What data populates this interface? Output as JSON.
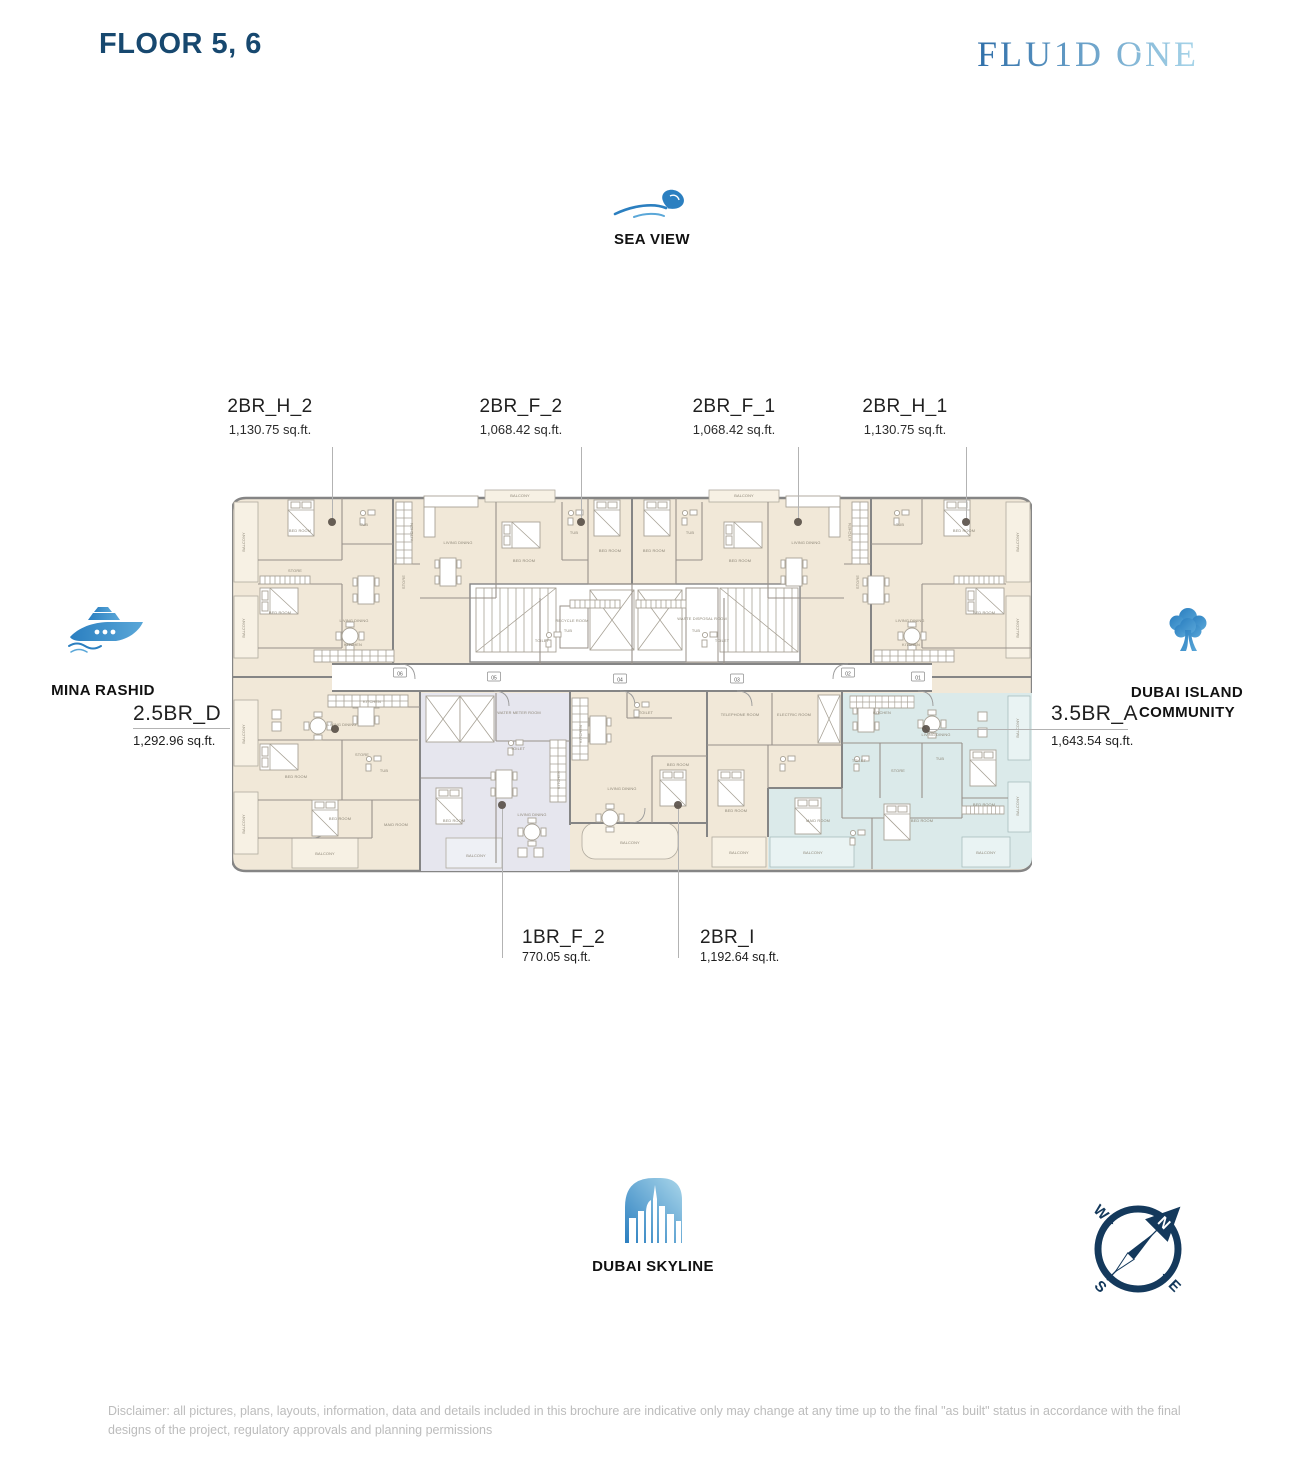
{
  "page": {
    "title": "FLOOR 5, 6",
    "brand": "FLU1D ONE",
    "disclaimer": "Disclaimer: all pictures, plans, layouts, information, data and details included in this brochure are indicative only may change at any time up to the final \"as built\" status in accordance with the final designs of the project, regulatory approvals and planning permissions"
  },
  "landmarks": {
    "top": {
      "label": "SEA VIEW",
      "icon": "wave-icon"
    },
    "left": {
      "label": "MINA RASHID",
      "icon": "ship-icon"
    },
    "right": {
      "label": "DUBAI ISLAND COMMUNITY",
      "icon": "tree-icon"
    },
    "bottom": {
      "label": "DUBAI SKYLINE",
      "icon": "skyline-icon"
    }
  },
  "units": [
    {
      "id": "2BR_H_2",
      "area": "1,130.75 sq.ft."
    },
    {
      "id": "2BR_F_2",
      "area": "1,068.42 sq.ft."
    },
    {
      "id": "2BR_F_1",
      "area": "1,068.42 sq.ft."
    },
    {
      "id": "2BR_H_1",
      "area": "1,130.75 sq.ft."
    },
    {
      "id": "2.5BR_D",
      "area": "1,292.96 sq.ft."
    },
    {
      "id": "3.5BR_A",
      "area": "1,643.54 sq.ft."
    },
    {
      "id": "1BR_F_2",
      "area": "770.05 sq.ft."
    },
    {
      "id": "2BR_I",
      "area": "1,192.64 sq.ft."
    }
  ],
  "compass": {
    "n": "N",
    "e": "E",
    "s": "S",
    "w": "W"
  },
  "colors": {
    "navy": "#17486f",
    "compass_navy": "#14395c",
    "brand_blue_dark": "#2f6fa9",
    "brand_blue_light": "#a9d6ea",
    "icon_blue": "#2b7fc0",
    "icon_blue_light": "#5aa7d8",
    "plan_cream": "#f1e8d8",
    "plan_highlight_blue": "#dbeaea",
    "plan_highlight_gray": "#e6e6ee",
    "wall_gray": "#858585",
    "disclaimer_gray": "#bcbcbc"
  },
  "plan": {
    "labels": [
      {
        "t": "BALCONY",
        "x": 13,
        "y": 54,
        "r": -90
      },
      {
        "t": "BED ROOM",
        "x": 68,
        "y": 44
      },
      {
        "t": "TUB",
        "x": 132,
        "y": 38
      },
      {
        "t": "STORE",
        "x": 63,
        "y": 84,
        "s": 3.2
      },
      {
        "t": "BED ROOM",
        "x": 48,
        "y": 126
      },
      {
        "t": "LIVING DINING",
        "x": 122,
        "y": 134
      },
      {
        "t": "KITCHEN",
        "x": 121,
        "y": 158,
        "s": 3.2
      },
      {
        "t": "BALCONY",
        "x": 13,
        "y": 140,
        "r": -90
      },
      {
        "t": "KITCHEN",
        "x": 181,
        "y": 44,
        "r": -90
      },
      {
        "t": "STORE",
        "x": 173,
        "y": 94,
        "r": -90,
        "s": 3.2
      },
      {
        "t": "BALCONY",
        "x": 288,
        "y": 9
      },
      {
        "t": "LIVING DINING",
        "x": 226,
        "y": 56
      },
      {
        "t": "BED ROOM",
        "x": 292,
        "y": 74
      },
      {
        "t": "TUB",
        "x": 342,
        "y": 46
      },
      {
        "t": "BED ROOM",
        "x": 378,
        "y": 64
      },
      {
        "t": "TUB",
        "x": 336,
        "y": 144
      },
      {
        "t": "TOILET",
        "x": 310,
        "y": 154,
        "s": 3.2
      },
      {
        "t": "BED ROOM",
        "x": 422,
        "y": 64
      },
      {
        "t": "TUB",
        "x": 458,
        "y": 46
      },
      {
        "t": "BED ROOM",
        "x": 508,
        "y": 74
      },
      {
        "t": "LIVING DINING",
        "x": 574,
        "y": 56
      },
      {
        "t": "BALCONY",
        "x": 512,
        "y": 9
      },
      {
        "t": "TOILET",
        "x": 490,
        "y": 154,
        "s": 3.2
      },
      {
        "t": "TUB",
        "x": 464,
        "y": 144
      },
      {
        "t": "KITCHEN",
        "x": 619,
        "y": 44,
        "r": -90
      },
      {
        "t": "STORE",
        "x": 627,
        "y": 94,
        "r": -90,
        "s": 3.2
      },
      {
        "t": "TUB",
        "x": 668,
        "y": 38
      },
      {
        "t": "BED ROOM",
        "x": 732,
        "y": 44
      },
      {
        "t": "BALCONY",
        "x": 787,
        "y": 54,
        "r": -90
      },
      {
        "t": "LIVING DINING",
        "x": 678,
        "y": 134
      },
      {
        "t": "KITCHEN",
        "x": 679,
        "y": 158,
        "s": 3.2
      },
      {
        "t": "BED ROOM",
        "x": 752,
        "y": 126
      },
      {
        "t": "BALCONY",
        "x": 787,
        "y": 140,
        "r": -90
      },
      {
        "t": "RECYCLE ROOM",
        "x": 340,
        "y": 134,
        "s": 3.0
      },
      {
        "t": "WASTE DISPOSAL ROOM",
        "x": 470,
        "y": 132,
        "s": 3.0
      },
      {
        "t": "KITCHEN",
        "x": 140,
        "y": 215,
        "s": 3.2
      },
      {
        "t": "LIVING DINING",
        "x": 110,
        "y": 238
      },
      {
        "t": "BALCONY",
        "x": 13,
        "y": 246,
        "r": -90
      },
      {
        "t": "BED ROOM",
        "x": 64,
        "y": 290
      },
      {
        "t": "STORE",
        "x": 130,
        "y": 268,
        "s": 3.2
      },
      {
        "t": "TUB",
        "x": 152,
        "y": 284
      },
      {
        "t": "BALCONY",
        "x": 13,
        "y": 336,
        "r": -90
      },
      {
        "t": "BED ROOM",
        "x": 108,
        "y": 332
      },
      {
        "t": "MAID ROOM",
        "x": 164,
        "y": 338,
        "s": 3.2
      },
      {
        "t": "BALCONY",
        "x": 93,
        "y": 367
      },
      {
        "t": "WATER METER ROOM",
        "x": 287,
        "y": 226,
        "s": 3.0
      },
      {
        "t": "TOILET",
        "x": 286,
        "y": 262,
        "s": 3.2
      },
      {
        "t": "BED ROOM",
        "x": 222,
        "y": 334
      },
      {
        "t": "LIVING DINING",
        "x": 300,
        "y": 328
      },
      {
        "t": "KITCHEN",
        "x": 328,
        "y": 292,
        "r": -90
      },
      {
        "t": "BALCONY",
        "x": 244,
        "y": 369
      },
      {
        "t": "KITCHEN",
        "x": 350,
        "y": 246,
        "r": -90
      },
      {
        "t": "TOILET",
        "x": 414,
        "y": 226,
        "s": 3.2
      },
      {
        "t": "LIVING DINING",
        "x": 390,
        "y": 302
      },
      {
        "t": "BED ROOM",
        "x": 446,
        "y": 278
      },
      {
        "t": "BALCONY",
        "x": 398,
        "y": 356
      },
      {
        "t": "TELEPHONE ROOM",
        "x": 508,
        "y": 228,
        "s": 3.0
      },
      {
        "t": "ELECTRIC ROOM",
        "x": 562,
        "y": 228,
        "s": 3.0
      },
      {
        "t": "BED ROOM",
        "x": 504,
        "y": 324
      },
      {
        "t": "BALCONY",
        "x": 507,
        "y": 366
      },
      {
        "t": "KITCHEN",
        "x": 650,
        "y": 226,
        "s": 3.2
      },
      {
        "t": "LIVING DINING",
        "x": 704,
        "y": 248
      },
      {
        "t": "BALCONY",
        "x": 787,
        "y": 240,
        "r": -90
      },
      {
        "t": "TOILET",
        "x": 627,
        "y": 274,
        "s": 3.2
      },
      {
        "t": "STORE",
        "x": 666,
        "y": 284,
        "s": 3.2
      },
      {
        "t": "TUB",
        "x": 708,
        "y": 272
      },
      {
        "t": "BED ROOM",
        "x": 752,
        "y": 318
      },
      {
        "t": "BALCONY",
        "x": 787,
        "y": 318,
        "r": -90
      },
      {
        "t": "BED ROOM",
        "x": 690,
        "y": 334
      },
      {
        "t": "MAID ROOM",
        "x": 586,
        "y": 334,
        "s": 3.2
      },
      {
        "t": "BALCONY",
        "x": 581,
        "y": 366
      },
      {
        "t": "BALCONY",
        "x": 754,
        "y": 366
      }
    ],
    "badges": [
      {
        "n": "06",
        "x": 168,
        "y": 186
      },
      {
        "n": "05",
        "x": 262,
        "y": 190
      },
      {
        "n": "04",
        "x": 388,
        "y": 192
      },
      {
        "n": "03",
        "x": 505,
        "y": 192
      },
      {
        "n": "02",
        "x": 616,
        "y": 186
      },
      {
        "n": "01",
        "x": 686,
        "y": 190
      }
    ]
  }
}
